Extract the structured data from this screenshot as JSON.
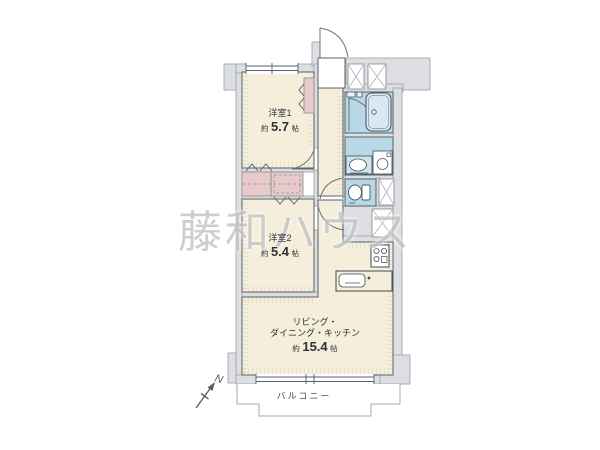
{
  "watermark_text": "藤和ハウス",
  "compass": {
    "label": "N"
  },
  "rooms": {
    "bedroom1": {
      "name": "洋室1",
      "area_prefix": "約",
      "area_value": "5.7",
      "area_unit": "帖"
    },
    "bedroom2": {
      "name": "洋室2",
      "area_prefix": "約",
      "area_value": "5.4",
      "area_unit": "帖"
    },
    "ldk": {
      "name_line1": "リビング・",
      "name_line2": "ダイニング・キッチン",
      "area_prefix": "約",
      "area_value": "15.4",
      "area_unit": "帖"
    },
    "balcony": {
      "name": "バルコニー"
    }
  },
  "colors": {
    "floor": "#f4eedb",
    "wall_fill": "#dcdee1",
    "wet_area": "#b8d8e8",
    "closet": "#e8caca",
    "line": "#596068",
    "watermark": "#c3c3c3"
  }
}
